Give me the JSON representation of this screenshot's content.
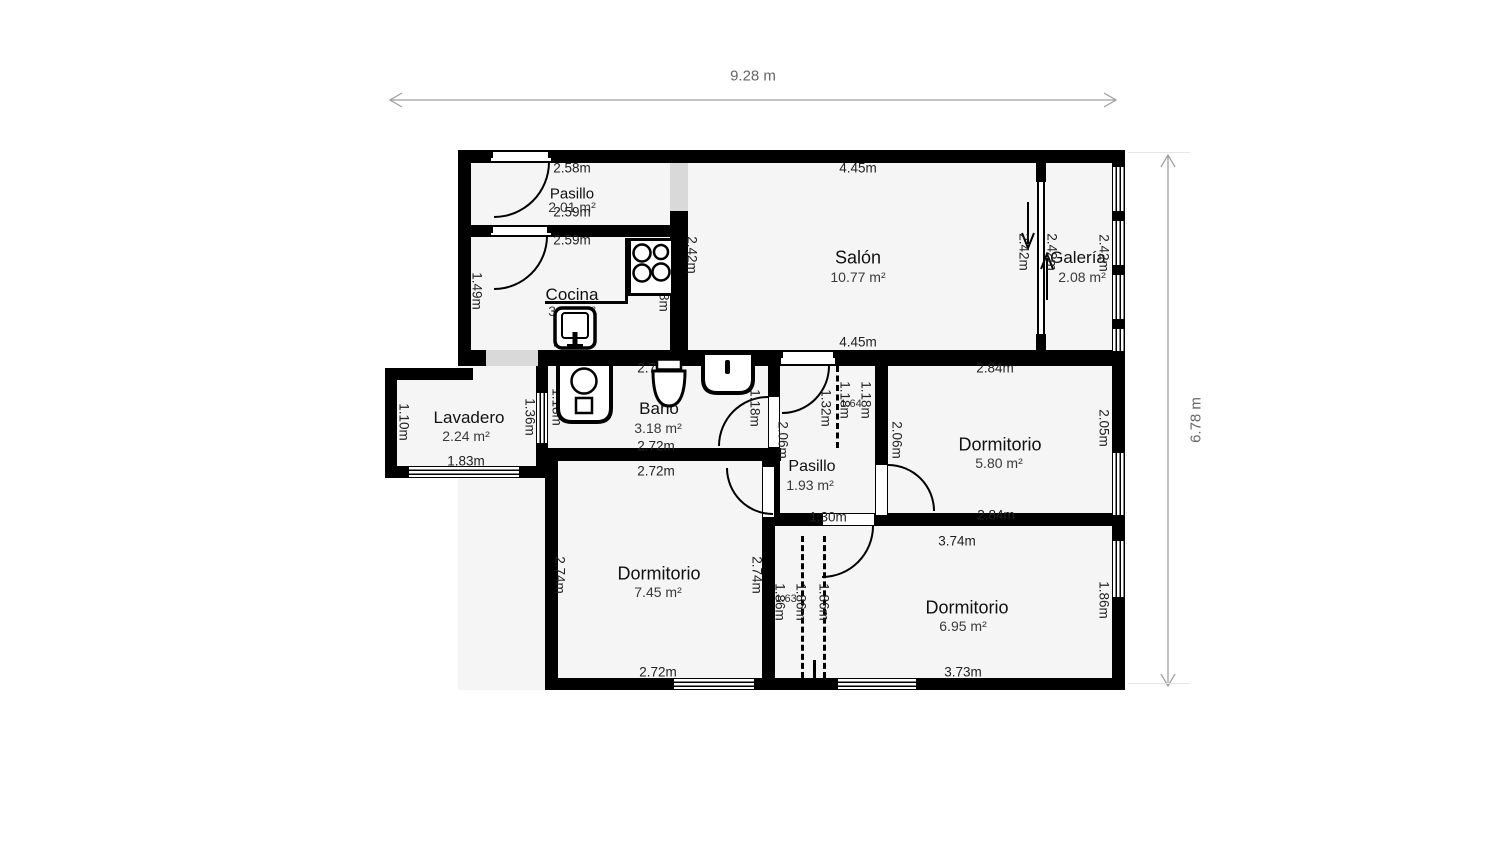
{
  "overall": {
    "width": "9.28 m",
    "height": "6.78 m"
  },
  "rooms": {
    "pasillo_top": {
      "name": "Pasillo",
      "area": "2.01 m²"
    },
    "cocina": {
      "name": "Cocina",
      "area": "3.84 m²"
    },
    "salon": {
      "name": "Salón",
      "area": "10.77 m²"
    },
    "galeria": {
      "name": "Galería",
      "area": "2.08 m²"
    },
    "lavadero": {
      "name": "Lavadero",
      "area": "2.24 m²"
    },
    "bano": {
      "name": "Baño",
      "area": "3.18 m²"
    },
    "pasillo_central": {
      "name": "Pasillo",
      "area": "1.93 m²"
    },
    "dormitorio_este": {
      "name": "Dormitorio",
      "area": "5.80 m²"
    },
    "dormitorio_suroeste": {
      "name": "Dormitorio",
      "area": "7.45 m²"
    },
    "dormitorio_sureste": {
      "name": "Dormitorio",
      "area": "6.95 m²"
    }
  },
  "measurements": {
    "m1": "2.58m",
    "m2": "2.59m",
    "m3": "2.59m",
    "m4": "2.59m",
    "m5": "4.45m",
    "m6": "4.45m",
    "m7": "1.83m",
    "m8": "2.71m",
    "m9": "2.72m",
    "m10": "2.72m",
    "m11": "1.30m",
    "m12": "2.84m",
    "m13": "2.84m",
    "m14": "2.72m",
    "m15": "3.74m",
    "m16": "3.73m",
    "m17": "1.64",
    "m18": "1.63",
    "m19": "1.49m",
    "m20": "2.42m",
    "m21": "1.48m",
    "m22": "2.42m",
    "m23": "2.42m",
    "m24": "2.42m",
    "m25": "1.10m",
    "m26": "1.36m",
    "m27": "1.18m",
    "m28": "1.18m",
    "m29": "2.06m",
    "m30": "2.06m",
    "m31": "1.32m",
    "m32": "1.18m",
    "m33": "1.18m",
    "m34": "2.05m",
    "m35": "2.74m",
    "m36": "2.74m",
    "m37": "1.86m",
    "m38": "1.86m",
    "m39": "1.86m",
    "m40": "1.86m"
  },
  "colors": {
    "wall": "#000000",
    "floor": "#f5f5f5",
    "opening": "#d9d9d9",
    "dimension_text": "#222222",
    "overall_dimension_text": "#666666"
  }
}
